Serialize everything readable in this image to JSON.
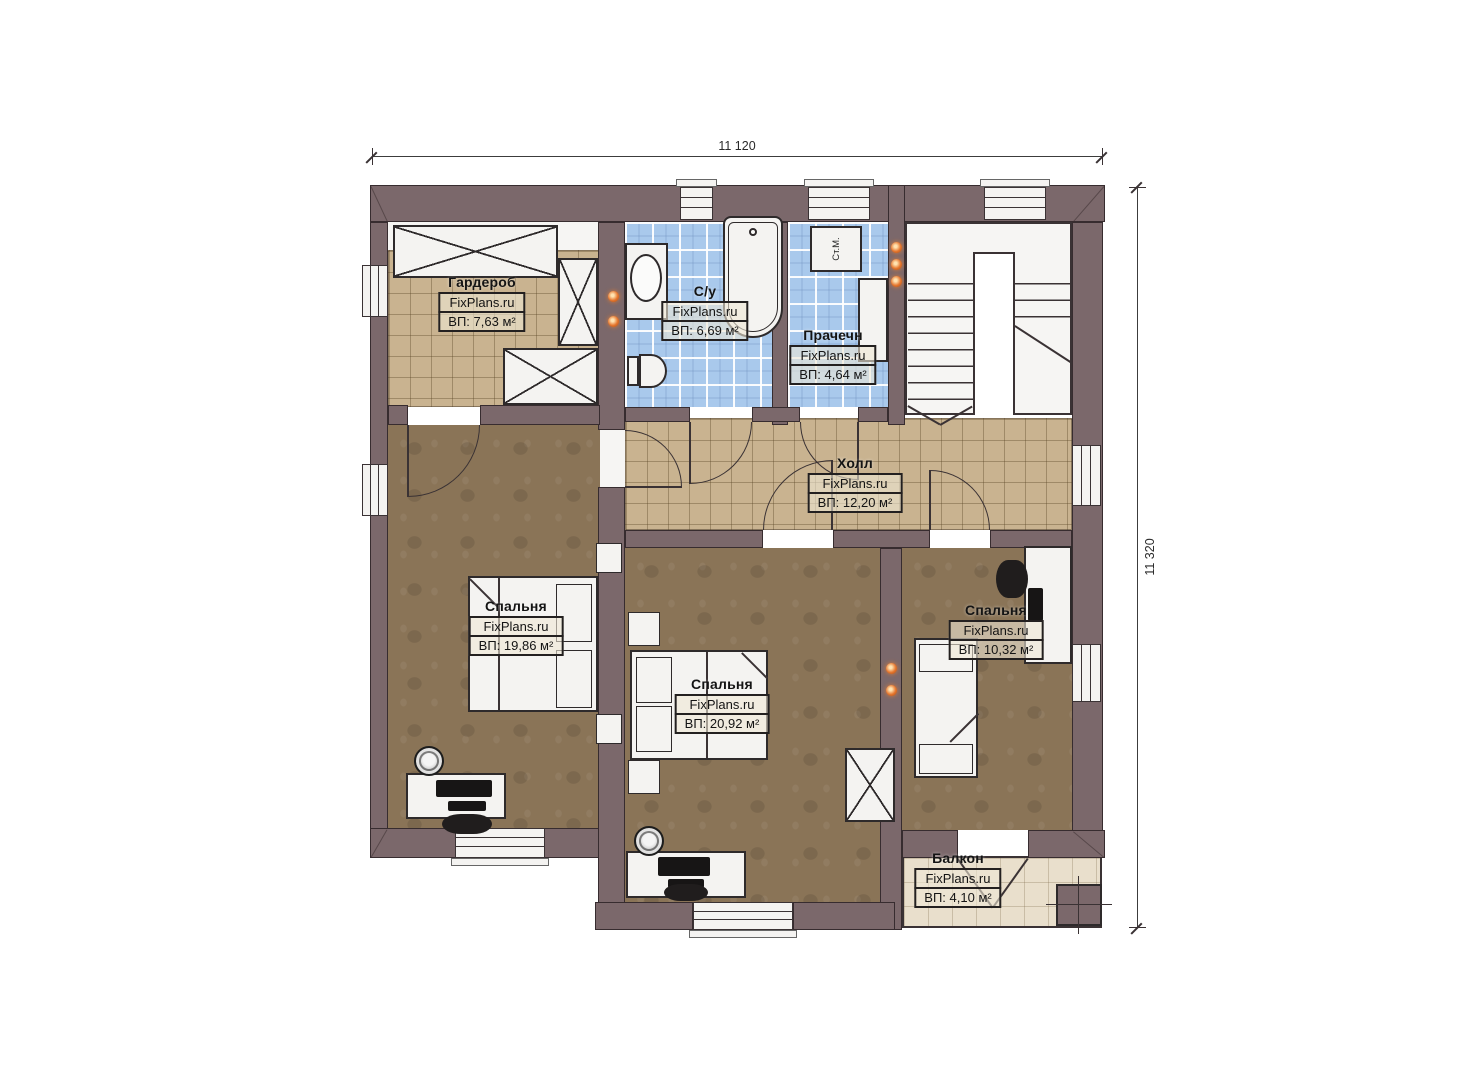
{
  "dimensions": {
    "width_label": "11 120",
    "height_label": "11 320"
  },
  "rooms": [
    {
      "id": "wardrobe",
      "name": "Гардероб",
      "brand": "FixPlans.ru",
      "area": "ВП: 7,63 м²"
    },
    {
      "id": "bathroom",
      "name": "С/у",
      "brand": "FixPlans.ru",
      "area": "ВП: 6,69 м²"
    },
    {
      "id": "laundry",
      "name": "Прачечн",
      "brand": "FixPlans.ru",
      "area": "ВП: 4,64 м²"
    },
    {
      "id": "hall",
      "name": "Холл",
      "brand": "FixPlans.ru",
      "area": "ВП: 12,20 м²"
    },
    {
      "id": "bedroom-left",
      "name": "Спальня",
      "brand": "FixPlans.ru",
      "area": "ВП: 19,86 м²"
    },
    {
      "id": "bedroom-middle",
      "name": "Спальня",
      "brand": "FixPlans.ru",
      "area": "ВП: 20,92 м²"
    },
    {
      "id": "bedroom-right",
      "name": "Спальня",
      "brand": "FixPlans.ru",
      "area": "ВП: 10,32 м²"
    },
    {
      "id": "balcony",
      "name": "Балкон",
      "brand": "FixPlans.ru",
      "area": "ВП: 4,10 м²"
    }
  ],
  "fixtures": {
    "washing_machine_label": "Ст.М."
  },
  "colors": {
    "wall": "#7b686b",
    "tile_tan": "#c9b390",
    "tile_blue": "#a9c9ec",
    "carpet": "#8a7457",
    "balcony": "#e9dfcc",
    "lamp_orange": "#e5762e"
  }
}
